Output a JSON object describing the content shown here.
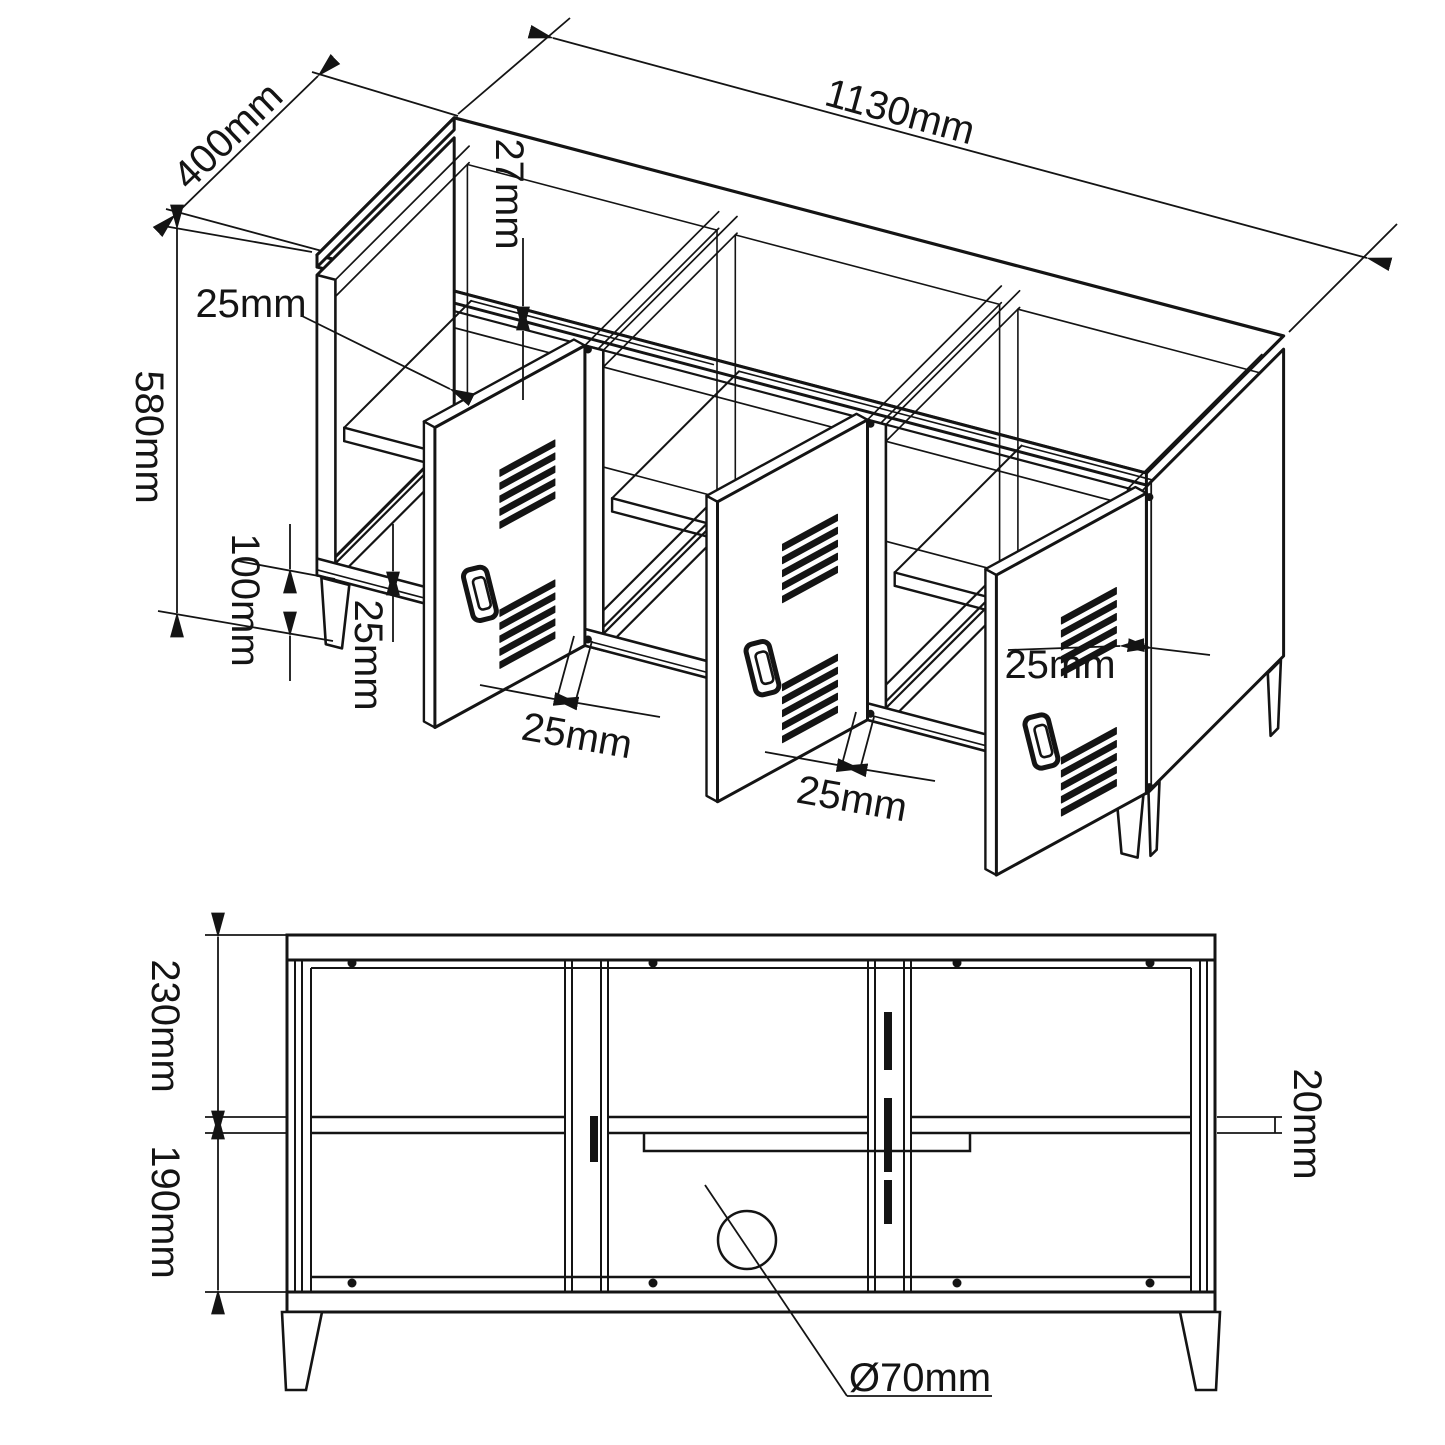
{
  "drawing": {
    "title": "TV stand technical drawing",
    "iso_view": {
      "depth": "400mm",
      "width": "1130mm",
      "top_thickness": "27mm",
      "shelf_thickness": "25mm",
      "height": "580mm",
      "leg_height": "100mm",
      "bottom_rail_thickness": "25mm",
      "door1_rail": "25mm",
      "door2_rail": "25mm",
      "door_thickness": "25mm"
    },
    "front_view": {
      "upper_section": "230mm",
      "lower_section": "190mm",
      "shelf_gap": "20mm",
      "cable_hole": "Ø70mm"
    },
    "line_color": "#141414"
  }
}
